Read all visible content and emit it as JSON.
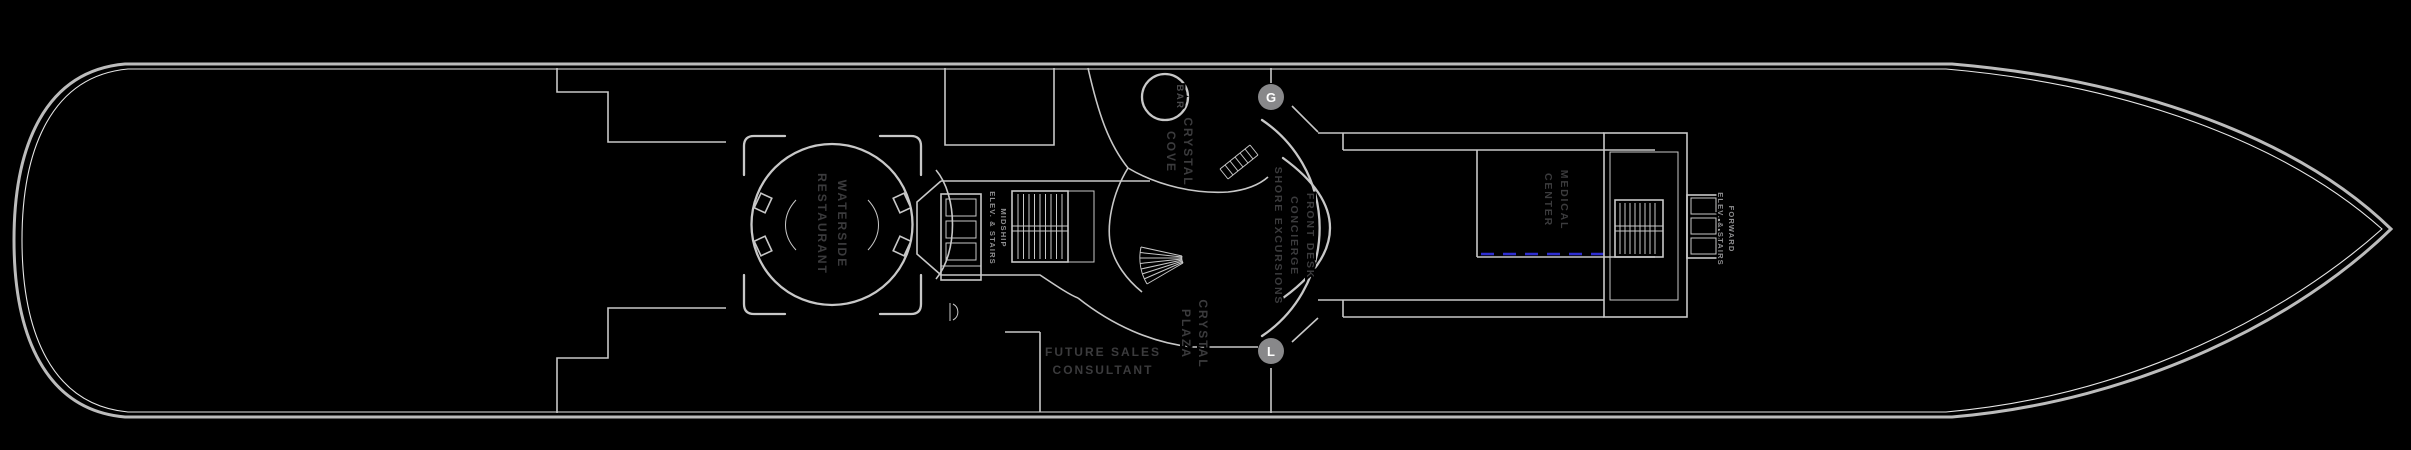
{
  "title": "Cruise ship deck plan",
  "colors": {
    "background": "#000000",
    "hull": "#bcbcbc",
    "hull_inner": "#e6e6e6",
    "wall": "#c8c8c8",
    "label_dark": "#3b3b3d",
    "label_light": "#8f8f91",
    "badge": "#88888a",
    "accent_blue": "#2d2dd0"
  },
  "labels": {
    "waterside": {
      "lines": [
        "WATERSIDE",
        "RESTAURANT"
      ]
    },
    "midship_elev": {
      "lines": [
        "MIDSHIP",
        "ELEV. & STAIRS"
      ]
    },
    "bar": "BAR",
    "crystal_cove": {
      "lines": [
        "CRYSTAL",
        "COVE"
      ]
    },
    "front_desk": {
      "lines": [
        "FRONT DESK",
        "CONCIERGE",
        "SHORE EXCURSIONS"
      ]
    },
    "crystal_plaza": {
      "lines": [
        "CRYSTAL",
        "PLAZA"
      ]
    },
    "medical": {
      "lines": [
        "MEDICAL",
        "CENTER"
      ]
    },
    "forward_elev": {
      "lines": [
        "FORWARD",
        "ELEV. & STAIRS"
      ]
    },
    "future_sales": {
      "lines": [
        "FUTURE SALES",
        "CONSULTANT"
      ]
    },
    "badges": {
      "gentlemen": "G",
      "ladies": "L"
    }
  }
}
